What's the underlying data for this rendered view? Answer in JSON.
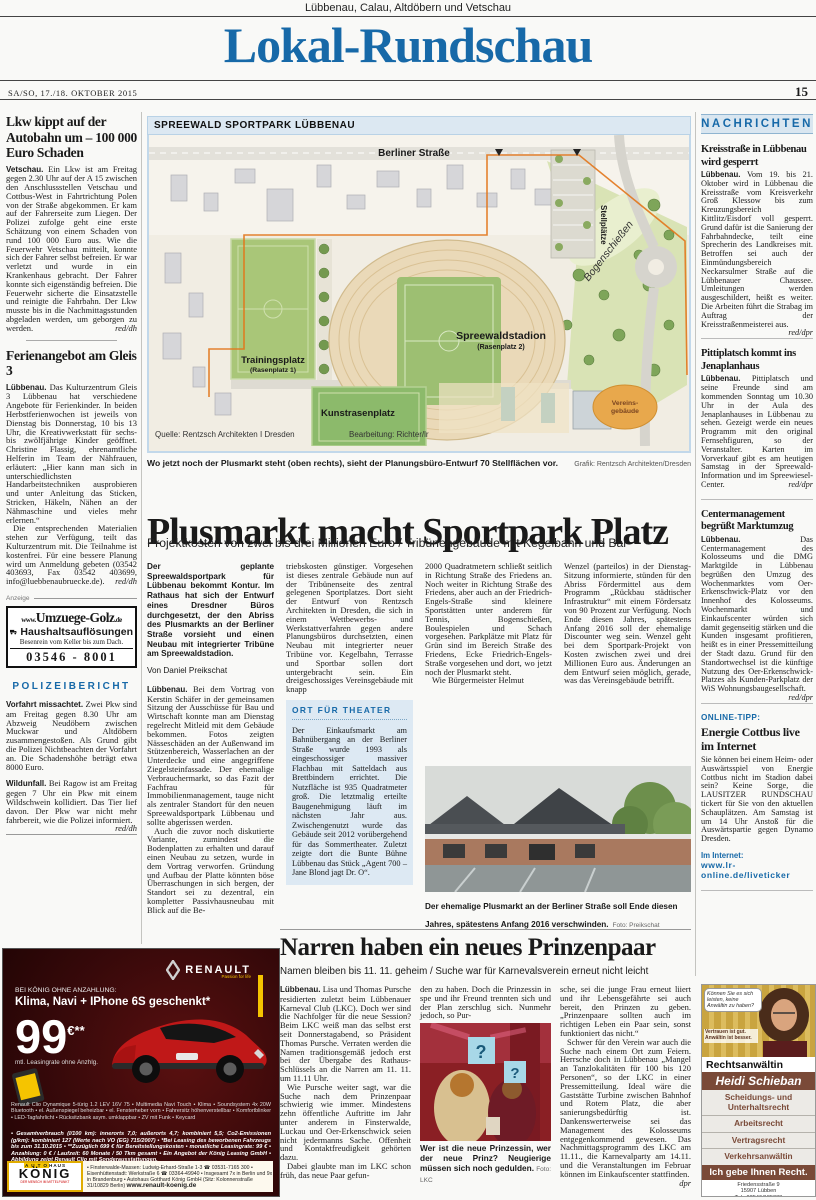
{
  "colors": {
    "masthead_blue": "#1769a8",
    "accent_blue": "#1769a8",
    "light_blue_bar": "#d9e6f0",
    "ad_brown": "#7a4a38",
    "renault_yellow": "#f5c400",
    "renault_red": "#c01818"
  },
  "header": {
    "region_line": "Lübbenau, Calau, Altdöbern und Vetschau",
    "masthead": "Lokal-Rundschau",
    "date_line": "SA/SO, 17./18. OKTOBER 2015",
    "page_number": "15"
  },
  "left": {
    "a1": {
      "headline": "Lkw kippt auf der Autobahn um – 100 000 Euro Schaden",
      "loc": "Vetschau.",
      "body": "Ein Lkw ist am Freitag gegen 2.30 Uhr auf der A 15 zwischen den Anschlussstellen Vetschau und Cottbus-West in Fahrtrichtung Polen von der Straße abgekommen. Er kam auf der Fahrerseite zum Liegen. Der Polizei zufolge geht eine erste Schätzung von einem Schaden von rund 100 000 Euro aus. Wie die Feuerwehr Vetschau mitteilt, konnte sich der Fahrer selbst befreien. Er war verletzt und wurde in ein Krankenhaus gebracht. Der Fahrer konnte sich eigenständig befreien. Die Feuerwehr sicherte die Einsatzstelle und reinigte die Fahrbahn. Der Lkw musste bis in die Nachmittagsstunden abgeladen werden, um geborgen zu werden.",
      "sig": "red/dh"
    },
    "a2": {
      "headline": "Ferienangebot am Gleis 3",
      "loc": "Lübbenau.",
      "p1": "Das Kulturzentrum Gleis 3 Lübbenau hat verschiedene Angebote für Ferienkinder. In beiden Herbstferienwochen ist jeweils von Dienstag bis Donnerstag, 10 bis 13 Uhr, die Kreativwerkstatt für sechs- bis zwölfjährige Kinder geöffnet. Christine Flassig, ehrenamtliche Helferin im Team der Nähfrauen, erläutert: „Hier kann man sich in unterschiedlichsten Handarbeitstechniken ausprobieren und unter Anleitung das Sticken, Stricken, Häkeln, Nähen an der Nähmaschine und vieles mehr erlernen.“",
      "p2": "Die entsprechenden Materialien stehen zur Verfügung, teilt das Kulturzentrum mit. Die Teilnahme ist kostenfrei. Für eine bessere Planung wird um Anmeldung gebeten (03542 403693, Fax 03542 403699, info@luebbenaubruecke.de).",
      "sig": "red/dh"
    },
    "anzeige_label": "Anzeige",
    "golz": {
      "url_pre": "www.",
      "url_main": "Umzuege-Golz",
      "url_suf": ".de",
      "line1": "Haushaltsauflösungen",
      "line2": "Besenrein vom Keller bis zum Dach.",
      "phone": "03546 - 8001"
    },
    "police": {
      "heading": "POLIZEIBERICHT",
      "i1_title": "Vorfahrt missachtet.",
      "i1_body": "Zwei Pkw sind am Freitag gegen 8.30 Uhr am Abzweig Neudöbern zwischen Muckwar und Altdöbern zusammengestoßen. Als Grund gibt die Polizei Nichtbeachten der Vorfahrt an. Die Schadenshöhe beträgt etwa 8000 Euro.",
      "i2_title": "Wildunfall.",
      "i2_body": "Bei Ragow ist am Freitag gegen 7 Uhr ein Pkw mit einem Wildschwein kollidiert. Das Tier lief davon. Der Pkw war nicht mehr fahrbereit, wie die Polizei informiert.",
      "sig": "red/dh"
    }
  },
  "map": {
    "title": "SPREEWALD SPORTPARK LÜBBENAU",
    "labels": {
      "strasse": "Berliner Straße",
      "stellplaetze": "Stellplätze",
      "bogen": "Bogenschießen",
      "stadion": "Spreewaldstadion",
      "stadion_sub": "(Rasenplatz 2)",
      "training": "Trainingsplatz",
      "training_sub": "(Rasenplatz 1)",
      "kunstrasen": "Kunstrasenplatz",
      "verein1": "Vereins-",
      "verein2": "gebäude",
      "quelle": "Quelle: Rentzsch Architekten I Dresden",
      "bearbeitung": "Bearbeitung: Richter/lr"
    },
    "caption": "Wo jetzt noch der Plusmarkt steht (oben rechts), sieht der Planungsbüro-Entwurf 70 Stellflächen vor.",
    "credit": "Grafik: Rentzsch Architekten/Dresden"
  },
  "main": {
    "headline": "Plusmarkt macht Sportpark Platz",
    "subhead": "Projektkosten von zwei bis drei Millionen Euro / Tribünengebäude mit Kegelbahn und Bar",
    "lead": "Der geplante Spreewaldsportpark für Lübbenau bekommt Kontur. Im Rathaus hat sich der Entwurf eines Dresdner Büros durchgesetzt, der den Abriss des Plusmarkts an der Berliner Straße vorsieht und einen Neubau mit integrierter Tribüne am Spreewaldstadion.",
    "byline": "Von Daniel Preikschat",
    "loc": "Lübbenau.",
    "c1p1": "Bei dem Vortrag von Kerstin Schäfer in der gemeinsamen Sitzung der Ausschüsse für Bau und Wirtschaft konnte man am Dienstag regelrecht Mitleid mit dem Gebäude bekommen. Fotos zeigten Nässeschäden an der Außenwand im Stützenbereich, Wasserlachen an der Unterdecke und eine angegriffene Ziegelsteinfassade. Der ehemalige Verbrauchermarkt, so das Fazit der Fachfrau für Immobilienmanagement, tauge nicht als zentraler Standort für den neuen Spreewaldsportpark Lübbenau und sollte abgerissen werden.",
    "c1p2": "Auch die zuvor noch diskutierte Variante, zumindest die Bodenplatten zu erhalten und darauf einen Neubau zu setzen, wurde in dem Vortrag verworfen. Gründung und Aufbau der Platte könnten böse Überraschungen in sich bergen, der Standort sei zu dezentral, ein kompletter Passivhausneubau mit Blick auf die Be-",
    "c2p": "triebskosten günstiger. Vorgesehen ist dieses zentrale Gebäude nun auf der Tribünenseite des zentral gelegenen Sportplatzes. Dort sieht der Entwurf von Rentzsch Architekten in Dresden, die sich in einem Wettbewerbs- und Werkstattverfahren gegen andere Planungsbüros durchsetzten, einen Neubau mit integrierter neuer Tribüne vor. Kegelbahn, Terrasse und Sportbar sollen dort untergebracht sein. Ein dreigeschossiges Vereinsgebäude mit knapp",
    "c3p1": "2000 Quadratmetern schließt seitlich in Richtung Straße des Friedens an. Noch weiter in Richtung Straße des Friedens, aber auch an der Friedrich-Engels-Straße sind kleinere Sportstätten unter anderem für Tennis, Bogenschießen, Boulespielen und Schach vorgesehen. Parkplätze mit Platz für Grün sind im Bereich Straße des Friedens, Ecke Friedrich-Engels-Straße vorgesehen und dort, wo jetzt noch der Plusmarkt steht.",
    "c3p2": "Wie Bürgermeister Helmut",
    "c4p": "Wenzel (parteilos) in der Dienstag-Sitzung informierte, stünden für den Abriss Fördermittel aus dem Programm „Rückbau städtischer Infrastruktur“ mit einem Fördersatz von 90 Prozent zur Verfügung. Noch Ende diesen Jahres, spätestens Anfang 2016 soll der ehemalige Discounter weg sein. Wenzel geht bei dem Sportpark-Projekt von Kosten zwischen zwei und drei Millionen Euro aus. Änderungen an dem Entwurf seien möglich, gerade, was das Vereinsgebäude betrifft.",
    "box": {
      "heading": "ORT FÜR THEATER",
      "body": "Der Einkaufsmarkt am Bahnübergang an der Berliner Straße wurde 1993 als eingeschossiger massiver Flachbau mit Satteldach aus Brettbindern errichtet. Die Nutzfläche ist 935 Quadratmeter groß. Die letztmalig erteilte Baugenehmigung läuft im nächsten Jahr aus. Zwischengenutzt wurde das Gebäude seit 2012 vorübergehend für das Sommertheater. Zuletzt zeigte dort die Bunte Bühne Lübbenau das Stück „Agent 700 – Jane Blond jagt Dr. O“."
    },
    "photo_caption": "Der ehemalige Plusmarkt an der Berliner Straße soll Ende diesen Jahres, spätestens Anfang 2016 verschwinden.",
    "photo_credit": "Foto: Preikschat"
  },
  "narren": {
    "headline": "Narren haben ein neues Prinzenpaar",
    "subhead": "Namen bleiben bis 11. 11. geheim / Suche war für Karnevalsverein erneut nicht leicht",
    "loc": "Lübbenau.",
    "c1p1": "Lisa und Thomas Pursche residierten zuletzt beim Lübbenauer Karneval Club (LKC). Doch wer sind die Nachfolger für die neue Session? Beim LKC weiß man das selbst erst seit Donnerstagabend, so Präsident Thomas Pursche. Verraten werden die Namen traditionsgemäß jedoch erst bei der Übergabe des Rathaus-Schlüssels an die Narren am 11. 11. um 11.11 Uhr.",
    "c1p2": "Wie Pursche weiter sagt, war die Suche nach dem Prinzenpaar schwierig wie immer. Mindestens zehn öffentliche Auftritte im Jahr unter anderem in Finsterwalde, Luckau und Oer-Erkenschwick seien nicht jedermanns Sache. Offenheit und Kontaktfreudigkeit gehörten dazu.",
    "c1p3": "Dabei glaubte man im LKC schon früh, das neue Paar gefun-",
    "c2p": "den zu haben. Doch die Prinzessin in spe und ihr Freund trennten sich und der Plan zerschlug sich. Nunmehr jedoch, so Pur-",
    "c3p1": "sche, sei die junge Frau erneut liiert und ihr Lebensgefährte sei auch bereit, den Prinzen zu geben. „Prinzenpaare sollten auch im richtigen Leben ein Paar sein, sonst funktioniert das nicht.“",
    "c3p2": "Schwer für den Verein war auch die Suche nach einem Ort zum Feiern. Herrsche doch in Lübbenau „Mangel an Tanzlokalitäten für 100 bis 120 Personen“, so der LKC in einer Pressemitteilung. Ideal wäre die Gaststätte Turbine zwischen Bahnhof und Rotem Platz, die aber sanierungsbedürftig ist. Dankenswerterweise sei das Management des Kolosseums entgegenkommend gewesen. Das Nachmittagsprogramm des LKC am 11.11., die Karnevalparty am 14.11. und die Veranstaltungen im Februar können im Einkaufscenter stattfinden.",
    "sig": "dpr",
    "photo_caption": "Wer ist die neue Prinzessin, wer der neue Prinz? Neugierige müssen sich noch gedulden.",
    "photo_credit": "Foto: LKC"
  },
  "news": {
    "heading": "NACHRICHTEN",
    "articles": [
      {
        "headline": "Kreisstraße in Lübbenau wird gesperrt",
        "loc": "Lübbenau.",
        "body": "Vom 19. bis 21. Oktober wird in Lübbenau die Kreisstraße vom Kreisverkehr Groß Klessow bis zum Kreuzungsbereich Kittlitz/Eisdorf voll gesperrt. Grund dafür ist die Sanierung der Fahrbahndecke, teilt eine Sprecherin des Landkreises mit. Betroffen sei auch der Einmündungsbereich Neckarsulmer Straße auf die Lübbenauer Chaussee. Umleitungen werden ausgeschildert, heißt es weiter. Die Arbeiten führt die Strabag im Auftrag der Kreisstraßenmeisterei aus.",
        "sig": "red/dpr"
      },
      {
        "headline": "Pittiplatsch kommt ins Jenaplanhaus",
        "loc": "Lübbenau.",
        "body": "Pittiplatsch und seine Freunde sind am kommenden Sonntag um 10.30 Uhr in der Aula des Jenaplanhauses in Lübbenau zu sehen. Gezeigt werde ein neues Programm mit den original Fernsehfiguren, so der Veranstalter. Karten im Vorverkauf gibt es am heutigen Samstag in der Spreewald-Information und im Spreewiesel-Center.",
        "sig": "red/dpr"
      },
      {
        "headline": "Centermanagement begrüßt Marktumzug",
        "loc": "Lübbenau.",
        "body": "Das Centermanagement des Kolosseums und die DMG Marktgilde in Lübbenau begrüßen den Umzug des Wochenmarktes vom Oer-Erkenschwick-Platz vor den Innenhof des Kolosseums. Wochenmarkt und Einkaufscenter würden sich damit gegenseitig stärken und die Kunden insgesamt profitieren, heißt es in einer Pressemitteilung der Stadt dazu. Grund für den Standortwechsel ist die künftige Nutzung des Oer-Erkenschwick-Platzes als Kunden-Parkplatz der WiS Wohnungsbaugesellschaft.",
        "sig": "red/dpr"
      }
    ],
    "online": {
      "label": "ONLINE-TIPP:",
      "headline": "Energie Cottbus live im Internet",
      "body": "Sie können bei einem Heim- oder Auswärtsspiel von Energie Cottbus nicht im Stadion dabei sein? Keine Sorge, die LAUSITZER RUNDSCHAU tickert für Sie von den aktuellen Schauplätzen. Am Samstag ist um 14 Uhr Anstoß für die Auswärtspartie gegen Dynamo Dresden.",
      "internet_label": "Im Internet:",
      "url": "www.lr-online.de/liveticker"
    }
  },
  "renault": {
    "brand": "RENAULT",
    "tagline": "Passion for life",
    "line1": "BEI KÖNIG OHNE ANZAHLUNG:",
    "line2": "Klima, Navi + IPhone 6S geschenkt*",
    "price": "99",
    "currency": "€**",
    "price_sub": "mtl. Leasingrate ohne Anzhlg.",
    "specs": "Renault Clio Dynamique 5-türig 1.2 LEV 16V 75 • Multimedia Navi Touch • Klima • Soundsystem 4x 20W Bluetooth • el. Außenspiegel beheizbar • el. Fensterheber vorn • Fahrersitz höhenverstellbar • Komfortblinker • LED-Tagfahrlicht • Rücksitzbank asym. umklappbar • ZV mit Funk • Keycard",
    "consumption": "• Gesamtverbrauch (l/100 km): innerorts 7,0; außerorts 4,7; kombiniert 5,5; Co2-Emissionen (g/km): kombiniert 127 (Werte nach VO (EG) 715/2007) • *Bei Leasing des beworbenen Fahrzeugs bis zum 31.10.2015 • **Zuzüglich 699 € für Bereitstellungskosten • monatliche Leasingrate: 99 € • Anzahlung: 0 € / Laufzeit: 60 Monate / 50 Tkm gesamt • Ein Angebot der König Leasing GmbH • Abbildung zeigt Renault Clio mit Sonderausstattungen.",
    "dealer_top": "AUTOHAUS",
    "dealer_name": "KÖNIG",
    "dealer_sub": "DER MENSCH IM MITTELPUNKT",
    "dealer_info": "• Finsterwalde-Massen: Ludwig-Erhard-Straße 1-3 ☎ 03531-7165 300 • Eisenhüttenstadt: Werkstraße 6 ☎ 03364-49940 • Insgesamt 7x in Berlin und 9x in Brandenburg • Autohaus Gotthard König GmbH (Sitz: Kolonnenstraße 31/10829 Berlin)",
    "dealer_url": "www.renault-koenig.de"
  },
  "schieban": {
    "bubble1": "Können Sie es sich leisten, keine Anwältin zu haben?",
    "bubble2": "Vertrauen ist gut. Anwältin ist besser.",
    "role": "Rechtsanwältin",
    "name": "Heidi Schieban",
    "items": [
      "Scheidungs- und Unterhaltsrecht",
      "Arbeitsrecht",
      "Vertragsrecht",
      "Verkehrsanwältin"
    ],
    "slogan": "Ich gebe Ihnen Recht.",
    "addr1": "Friedensstraße 9",
    "addr2": "15907 Lübben",
    "tel": "Tel.: 03546/185333",
    "fax": "Fax: 03546/185334",
    "email": "E-Mail: kanzlei@rechtsanwältin-schieban.de",
    "web": "www.rechtsanwältin-schieban.de"
  }
}
